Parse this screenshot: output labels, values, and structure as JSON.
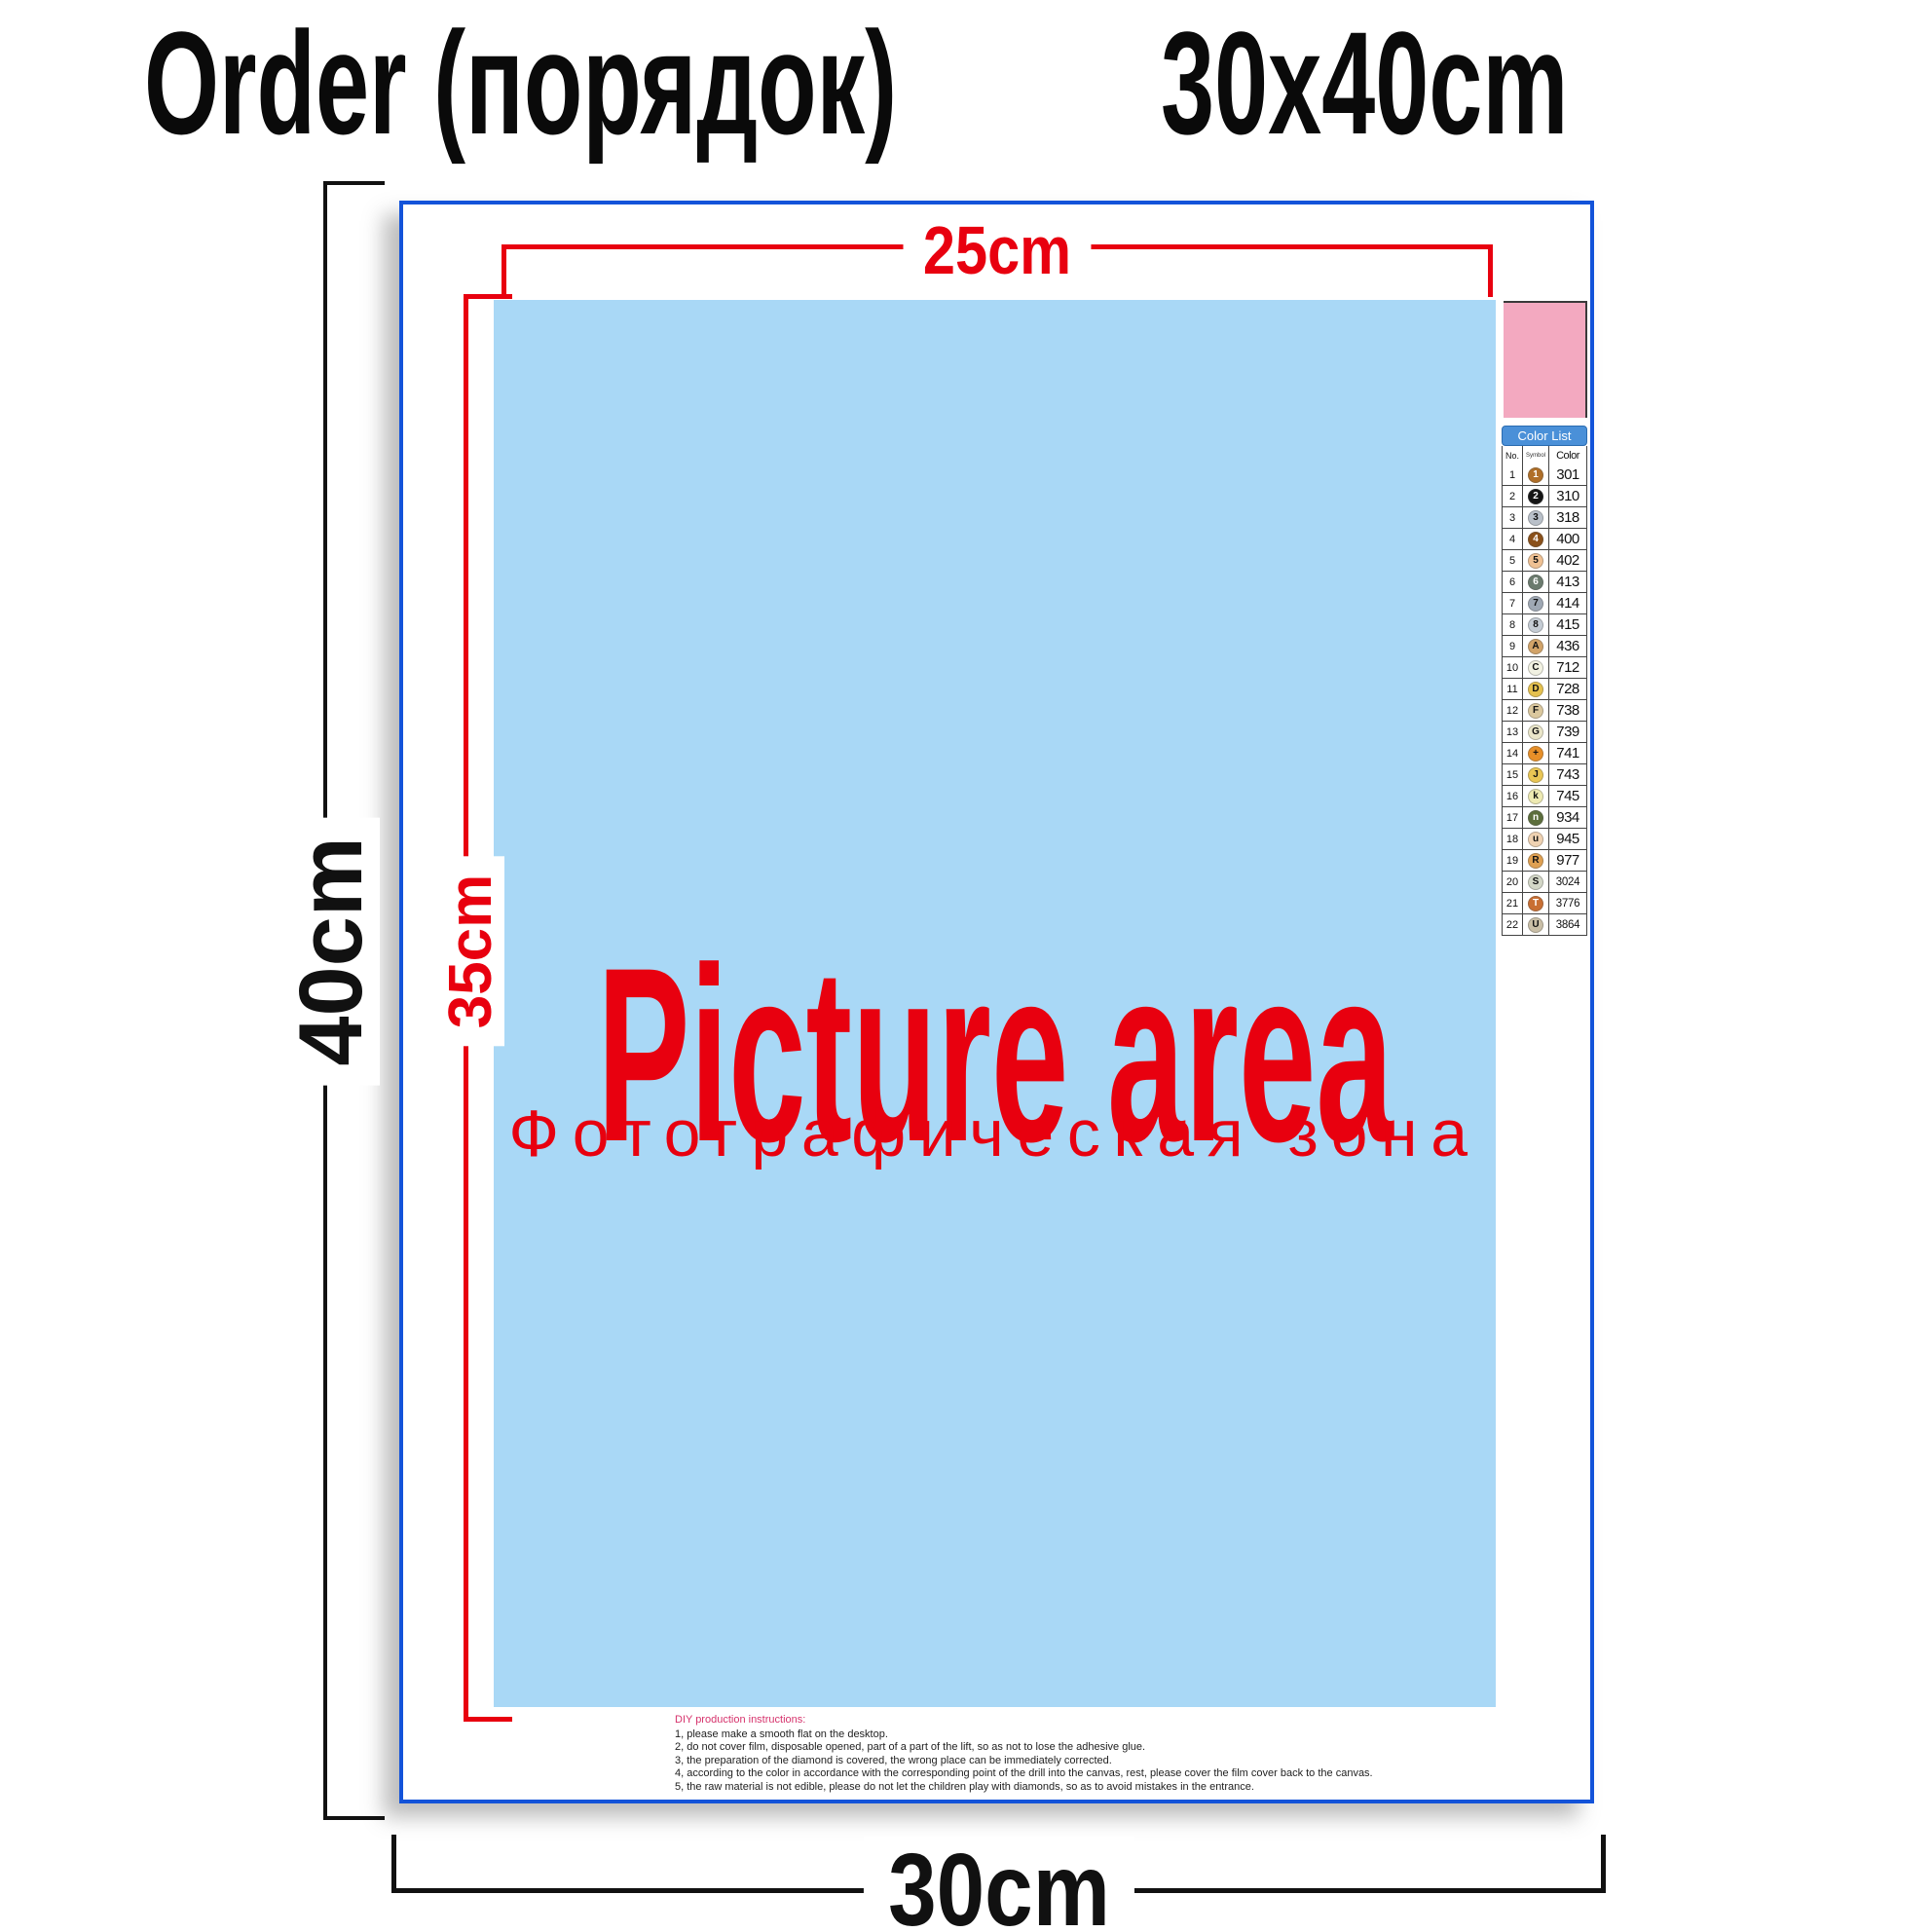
{
  "title": {
    "left": "Order (порядок)",
    "right": "30x40cm"
  },
  "dimensions": {
    "inner_width": "25cm",
    "inner_height": "35cm",
    "outer_height": "40cm",
    "outer_width": "30cm"
  },
  "picture_area": {
    "label": "Picture area",
    "label_ru": "Фотографическая зона"
  },
  "color_list": {
    "header": "Color List",
    "columns": {
      "no": "No.",
      "symbol": "Symbol",
      "color": "Color"
    },
    "rows": [
      {
        "no": 1,
        "symbol": "1",
        "code": "301",
        "swatch": "#b06f28",
        "text": "#ffffff"
      },
      {
        "no": 2,
        "symbol": "2",
        "code": "310",
        "swatch": "#151515",
        "text": "#ffffff"
      },
      {
        "no": 3,
        "symbol": "3",
        "code": "318",
        "swatch": "#b9c0c9",
        "text": "#111111"
      },
      {
        "no": 4,
        "symbol": "4",
        "code": "400",
        "swatch": "#8a5019",
        "text": "#ffffff"
      },
      {
        "no": 5,
        "symbol": "5",
        "code": "402",
        "swatch": "#efc193",
        "text": "#111111"
      },
      {
        "no": 6,
        "symbol": "6",
        "code": "413",
        "swatch": "#6b7b6e",
        "text": "#ffffff"
      },
      {
        "no": 7,
        "symbol": "7",
        "code": "414",
        "swatch": "#9fa8b4",
        "text": "#111111"
      },
      {
        "no": 8,
        "symbol": "8",
        "code": "415",
        "swatch": "#c5ccd4",
        "text": "#111111"
      },
      {
        "no": 9,
        "symbol": "A",
        "code": "436",
        "swatch": "#d2a368",
        "text": "#111111"
      },
      {
        "no": 10,
        "symbol": "C",
        "code": "712",
        "swatch": "#f2f2e2",
        "text": "#111111"
      },
      {
        "no": 11,
        "symbol": "D",
        "code": "728",
        "swatch": "#e5c14e",
        "text": "#111111"
      },
      {
        "no": 12,
        "symbol": "F",
        "code": "738",
        "swatch": "#dbc89e",
        "text": "#111111"
      },
      {
        "no": 13,
        "symbol": "G",
        "code": "739",
        "swatch": "#eae6c9",
        "text": "#111111"
      },
      {
        "no": 14,
        "symbol": "+",
        "code": "741",
        "swatch": "#e78f28",
        "text": "#111111"
      },
      {
        "no": 15,
        "symbol": "J",
        "code": "743",
        "swatch": "#eac654",
        "text": "#111111"
      },
      {
        "no": 16,
        "symbol": "k",
        "code": "745",
        "swatch": "#eeeab2",
        "text": "#111111"
      },
      {
        "no": 17,
        "symbol": "n",
        "code": "934",
        "swatch": "#5c6e3c",
        "text": "#ffffff"
      },
      {
        "no": 18,
        "symbol": "u",
        "code": "945",
        "swatch": "#efd2b2",
        "text": "#111111"
      },
      {
        "no": 19,
        "symbol": "R",
        "code": "977",
        "swatch": "#dfa051",
        "text": "#111111"
      },
      {
        "no": 20,
        "symbol": "S",
        "code": "3024",
        "swatch": "#d3d7c7",
        "text": "#111111"
      },
      {
        "no": 21,
        "symbol": "T",
        "code": "3776",
        "swatch": "#c96f33",
        "text": "#ffffff"
      },
      {
        "no": 22,
        "symbol": "U",
        "code": "3864",
        "swatch": "#cabfa7",
        "text": "#111111"
      }
    ]
  },
  "instructions": {
    "title": "DIY production instructions:",
    "lines": [
      "1, please make a smooth flat on the desktop.",
      "2, do not cover film, disposable opened, part of a part of the lift, so as not to lose the adhesive glue.",
      "3, the preparation of the diamond is covered, the wrong place can be immediately corrected.",
      "4, according to the color in accordance with the corresponding point of the drill into the canvas, rest, please cover the film cover back to the canvas.",
      "5, the raw material is not edible, please do not let the children play with diamonds, so as to avoid mistakes in the entrance."
    ]
  },
  "palette": {
    "accent_red": "#e8000f",
    "frame_blue": "#1353d9",
    "picture_blue": "#a9d8f6",
    "swatch_pink": "#f3a9c0",
    "header_blue": "#4a90d8"
  }
}
